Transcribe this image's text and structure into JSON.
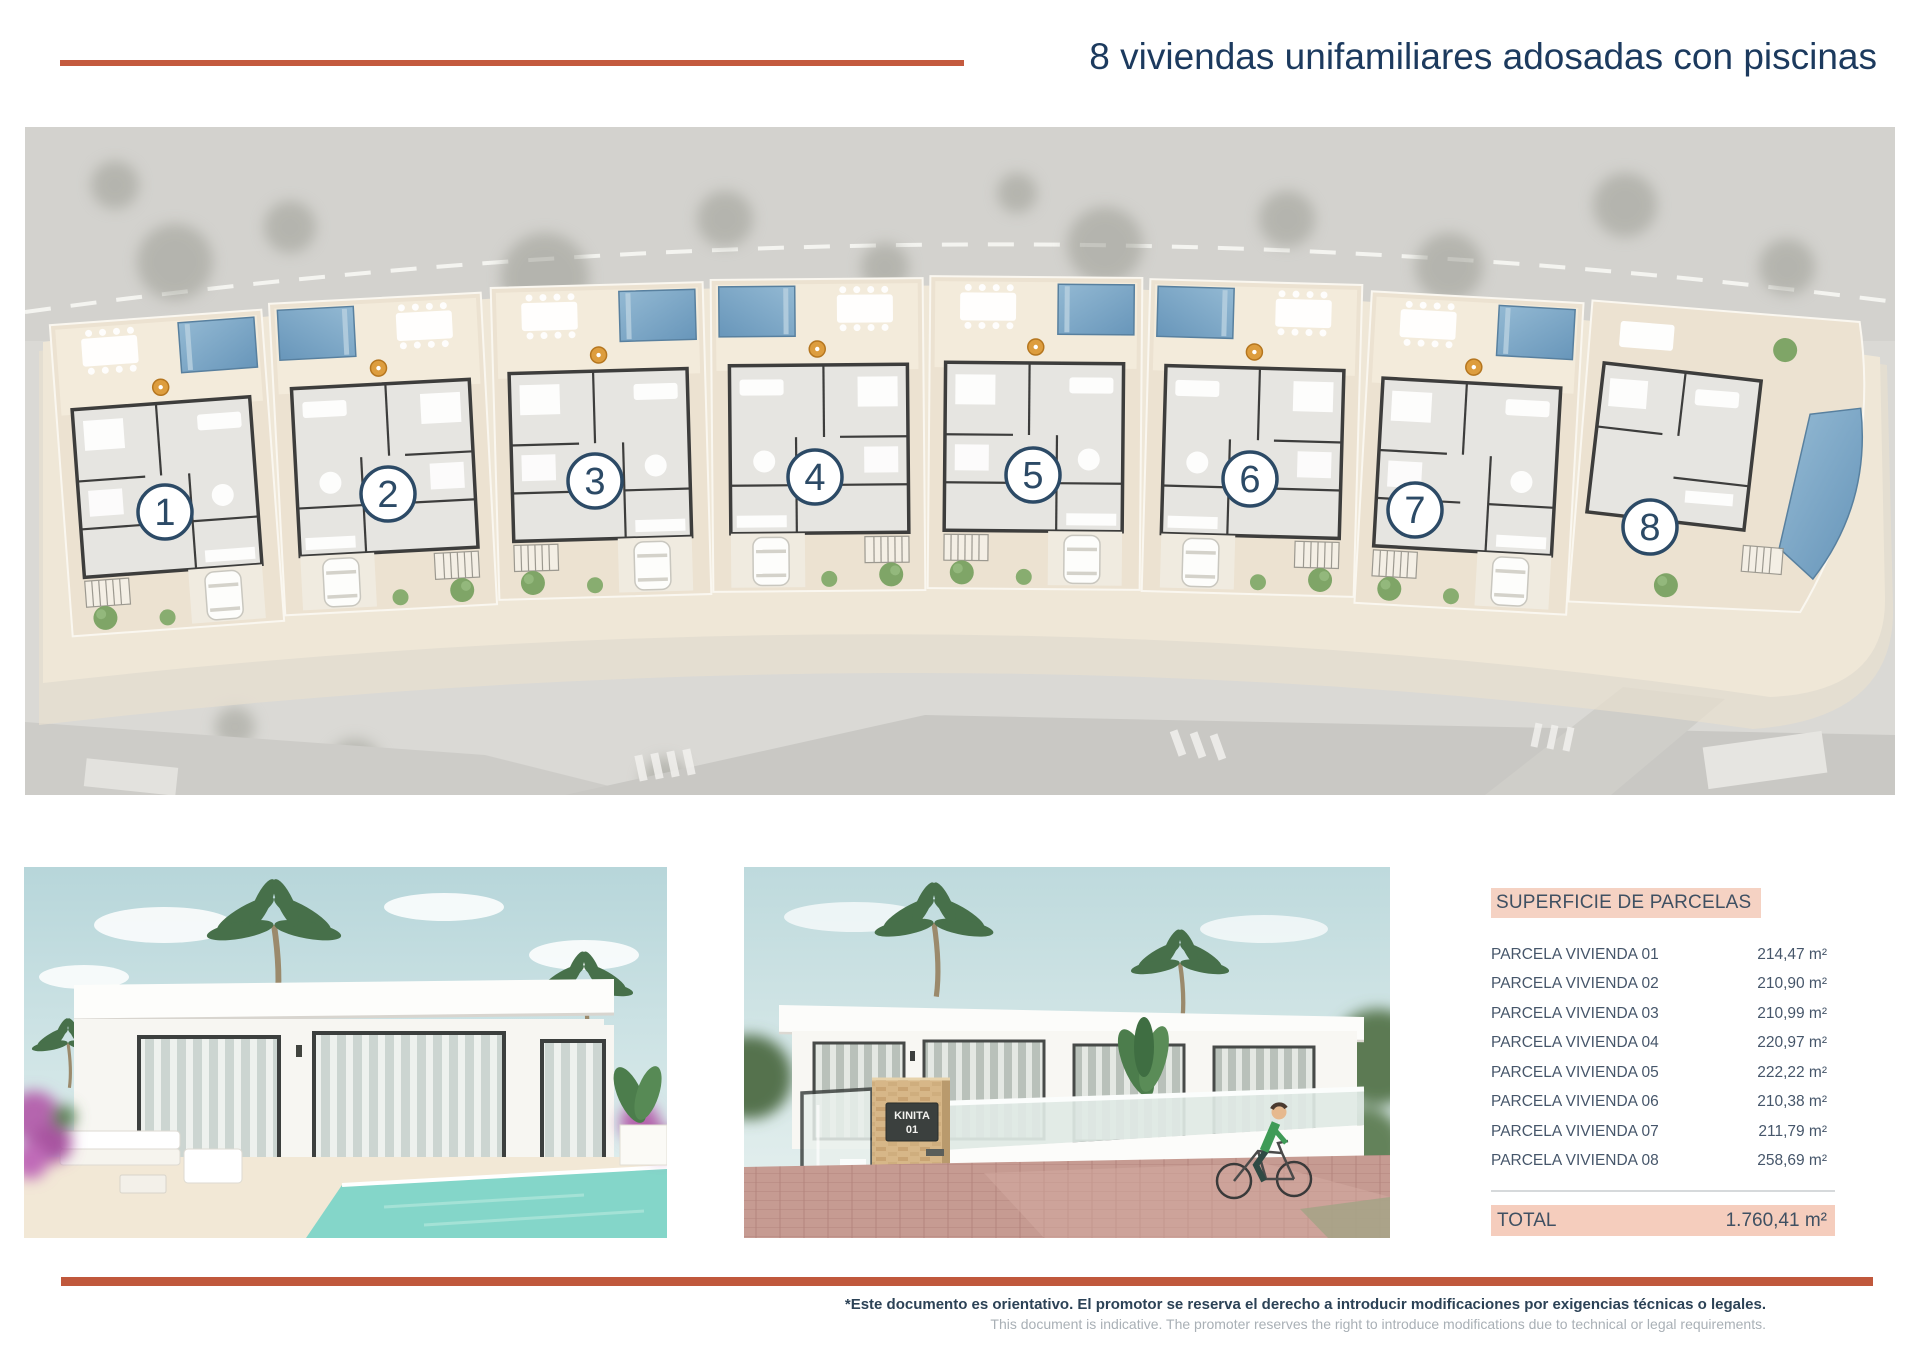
{
  "header": {
    "title": "8 viviendas unifamiliares adosadas con piscinas"
  },
  "site_plan": {
    "plots": [
      {
        "label": "1"
      },
      {
        "label": "2"
      },
      {
        "label": "3"
      },
      {
        "label": "4"
      },
      {
        "label": "5"
      },
      {
        "label": "6"
      },
      {
        "label": "7"
      },
      {
        "label": "8"
      }
    ]
  },
  "renders": {
    "street_sign": {
      "line1": "KINITA",
      "line2": "01"
    }
  },
  "surface_table": {
    "header": "SUPERFICIE DE PARCELAS",
    "rows": [
      {
        "label": "PARCELA VIVIENDA 01",
        "value": "214,47 m²"
      },
      {
        "label": "PARCELA VIVIENDA 02",
        "value": "210,90 m²"
      },
      {
        "label": "PARCELA VIVIENDA 03",
        "value": "210,99 m²"
      },
      {
        "label": "PARCELA VIVIENDA 04",
        "value": "220,97 m²"
      },
      {
        "label": "PARCELA VIVIENDA 05",
        "value": "222,22 m²"
      },
      {
        "label": "PARCELA VIVIENDA 06",
        "value": "210,38 m²"
      },
      {
        "label": "PARCELA VIVIENDA 07",
        "value": "211,79 m²"
      },
      {
        "label": "PARCELA VIVIENDA 08",
        "value": "258,69 m²"
      }
    ],
    "total": {
      "label": "TOTAL",
      "value": "1.760,41 m²"
    }
  },
  "footer": {
    "disclaimer_primary": "*Este documento es orientativo. El promotor se reserva el derecho a introducir modificaciones por exigencias técnicas o legales.",
    "disclaimer_secondary": "This document is indicative. The promoter reserves the right to introduce modifications due to technical or legal requirements."
  },
  "colors": {
    "accent": "#c45a3e",
    "navy": "#1c3a5e",
    "table_header_bg": "#f5d2c3",
    "table_total_bg": "#f5cdbd",
    "pool_blue": "#7aa9c8"
  }
}
